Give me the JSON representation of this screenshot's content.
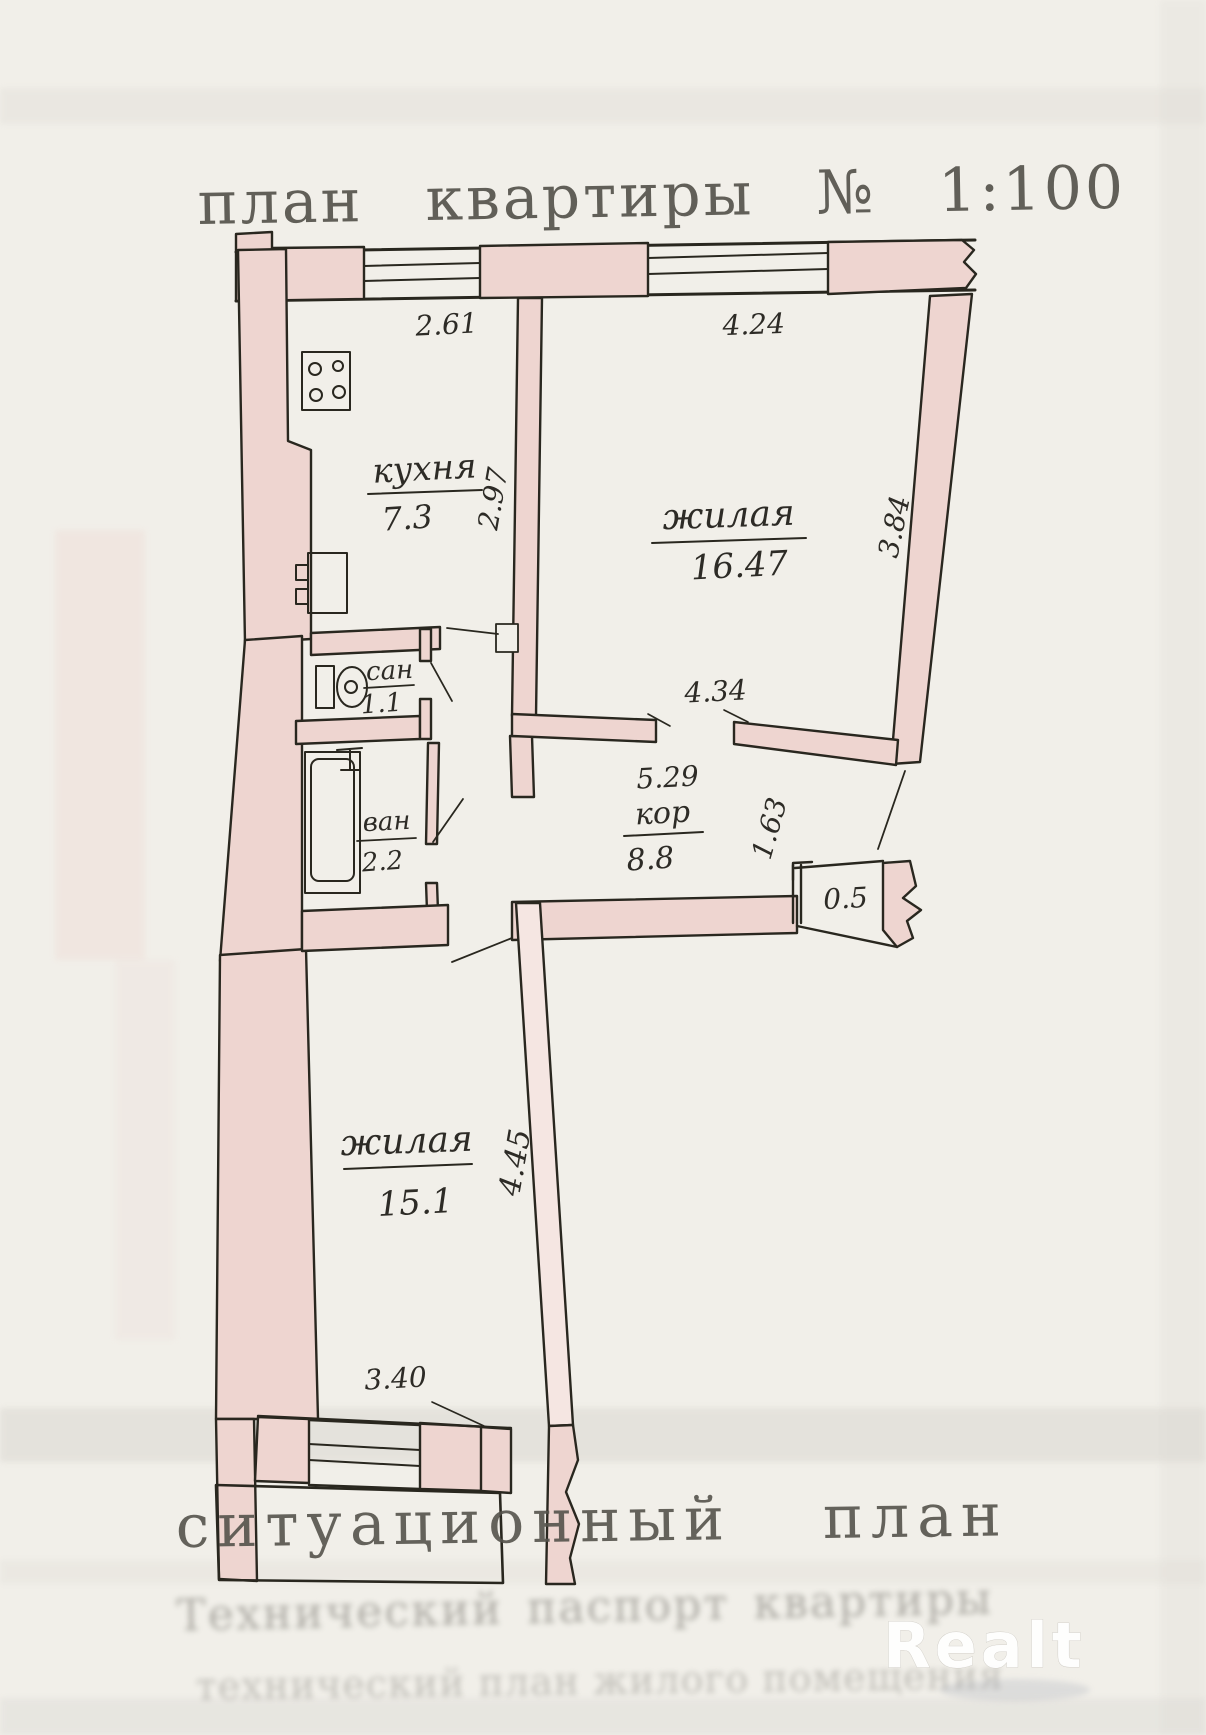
{
  "document": {
    "title": "план квартиры № 1:100",
    "footer_title": "ситуационный план",
    "watermark": "Realt"
  },
  "rooms": {
    "kitchen": {
      "label": "кухня",
      "area": "7.3"
    },
    "living1": {
      "label": "жилая",
      "area": "16.47"
    },
    "wc": {
      "label": "сан",
      "area": "1.1"
    },
    "bath": {
      "label": "ван",
      "area": "2.2"
    },
    "corridor": {
      "label": "кор",
      "area": "8.8"
    },
    "closet": {
      "area": "0.5"
    },
    "living2": {
      "label": "жилая",
      "area": "15.1"
    }
  },
  "dimensions": {
    "kitchen_top": "2.61",
    "living1_top": "4.24",
    "kitchen_side": "2.97",
    "living1_side": "3.84",
    "living1_bottom": "4.34",
    "corridor_length": "5.29",
    "corridor_width": "1.63",
    "living2_side": "4.45",
    "living2_bottom": "3.40"
  },
  "bleedthrough": {
    "line1": "Технический паспорт квартиры",
    "line2": "технический план жилого помещения"
  }
}
